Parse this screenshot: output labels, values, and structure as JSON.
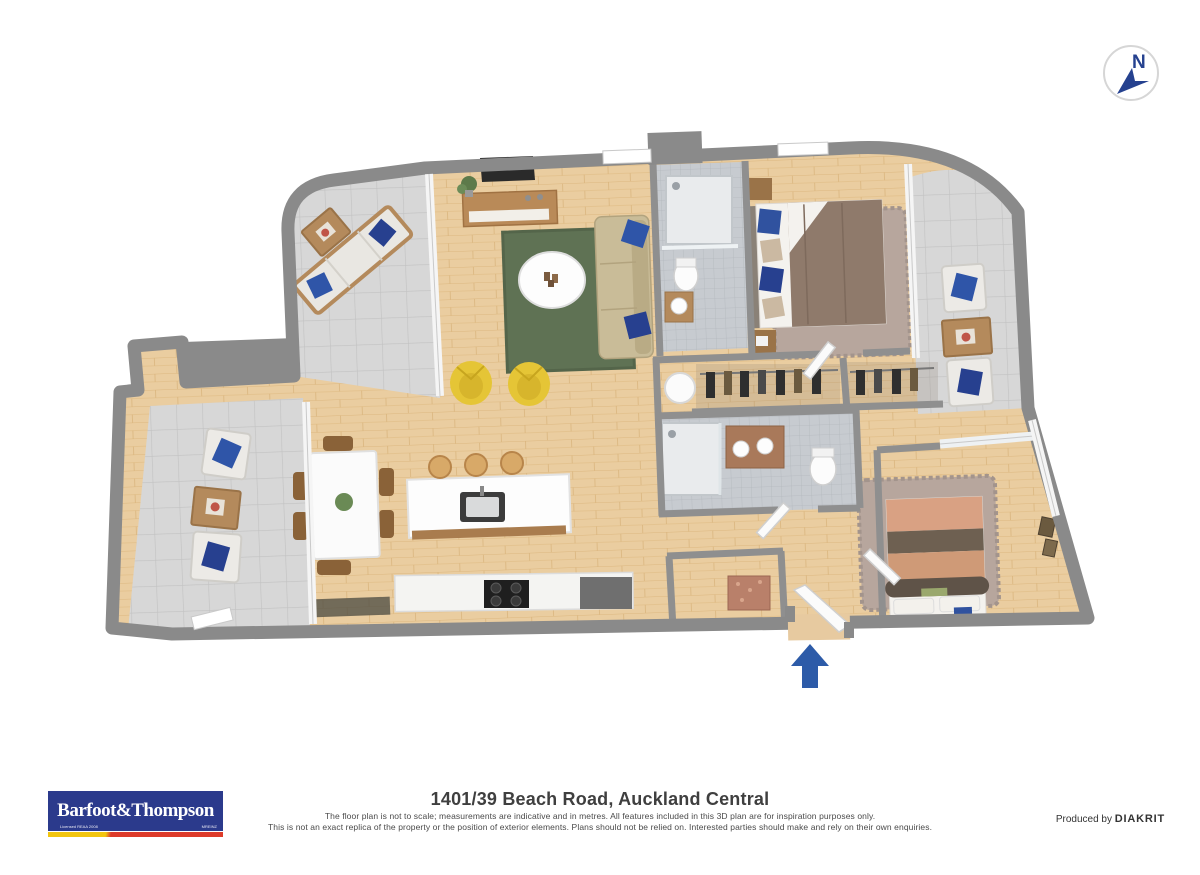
{
  "compass": {
    "label": "N"
  },
  "footer": {
    "title": "1401/39 Beach Road, Auckland Central",
    "disclaimer_line1": "The floor plan is not to scale; measurements are indicative and in metres. All features included in this 3D plan are for inspiration purposes only.",
    "disclaimer_line2": "This is not an exact replica of the property or the position of exterior elements. Plans should not be relied on. Interested parties should make and rely on their own enquiries.",
    "produced_by": "Produced by ",
    "producer": "DIAKRIT",
    "logo": {
      "brand": "Barfoot&Thompson",
      "licensed_text": "Licensed REAA 2008",
      "mreinz": "MREINZ"
    }
  },
  "colors": {
    "logo_blue": "#2b3a8c",
    "logo_yellow": "#f2c50f",
    "logo_red": "#dd3b2a",
    "compass_blue": "#25418f",
    "entrance_arrow": "#2d5ba8",
    "wall_gray": "#8a8a8a",
    "wood_floor": "#eacda0",
    "balcony_tile": "#d7d7d7",
    "bath_tile": "#c7cbd0",
    "rug_green": "#5f7254",
    "armchair_yellow": "#e5c536",
    "pillow_blue": "#2f55a8"
  }
}
